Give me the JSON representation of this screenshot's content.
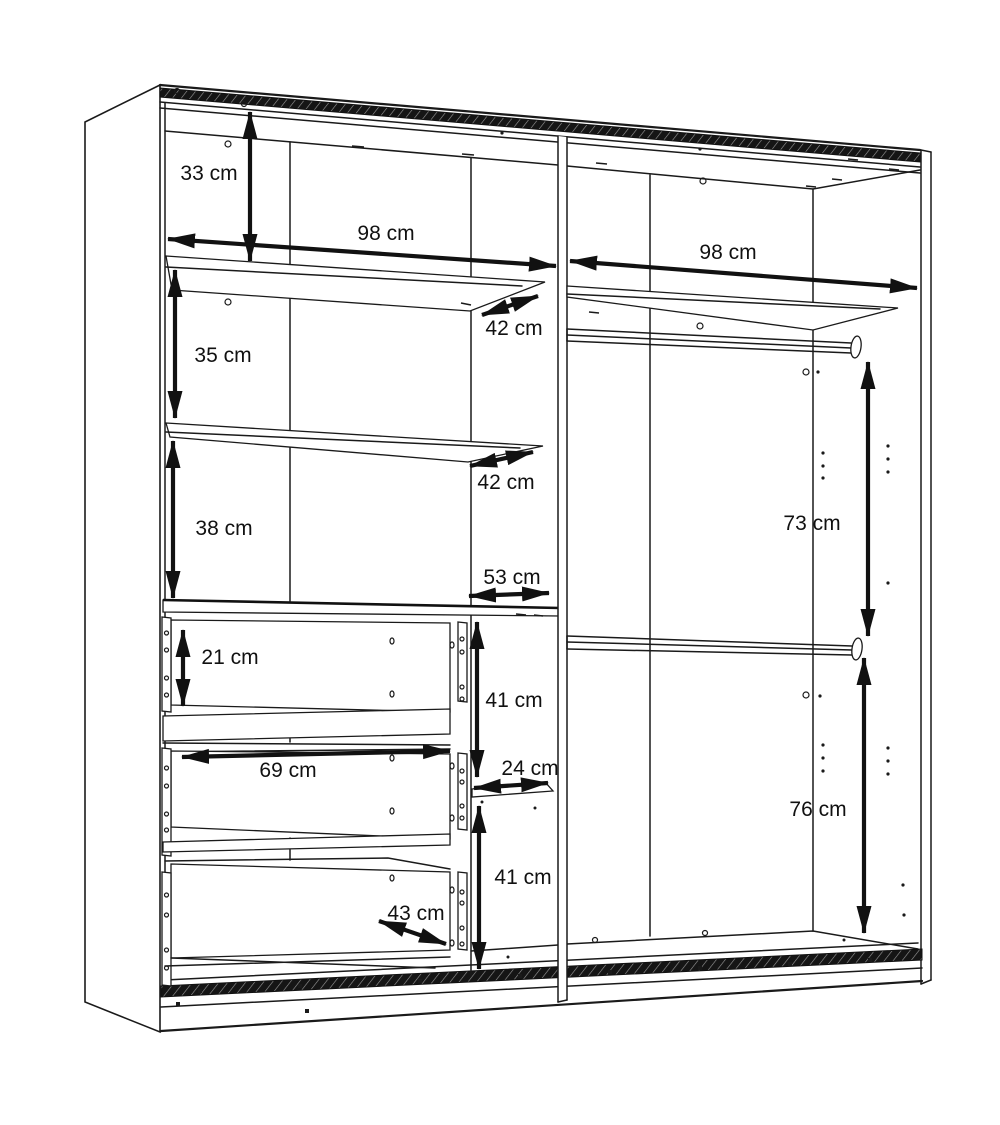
{
  "diagram": {
    "kind": "furniture dimension line drawing",
    "subject": "sliding-door wardrobe interior with shelves, three drawers and two hanging rails",
    "unit": "cm",
    "colors": {
      "background": "#ffffff",
      "line": "#1a1a1a",
      "rail_band": "#151515"
    },
    "dimensions": {
      "left_top_height": {
        "label": "33 cm"
      },
      "left_inner_width": {
        "label": "98 cm"
      },
      "upper_shelf_depth": {
        "label": "42 cm"
      },
      "left_section2_height": {
        "label": "35 cm"
      },
      "lower_shelf_depth": {
        "label": "42 cm"
      },
      "left_section3_height": {
        "label": "38 cm"
      },
      "drawer_top_depth": {
        "label": "53 cm"
      },
      "drawer_inner_height": {
        "label": "21 cm"
      },
      "drawer_inner_width": {
        "label": "69 cm"
      },
      "column_upper_height": {
        "label": "41 cm"
      },
      "column_shelf_depth": {
        "label": "24 cm"
      },
      "column_lower_height": {
        "label": "41 cm"
      },
      "drawer_depth": {
        "label": "43 cm"
      },
      "right_inner_width": {
        "label": "98 cm"
      },
      "right_hanging_top_height": {
        "label": "73 cm"
      },
      "right_hanging_low_height": {
        "label": "76 cm"
      }
    }
  }
}
